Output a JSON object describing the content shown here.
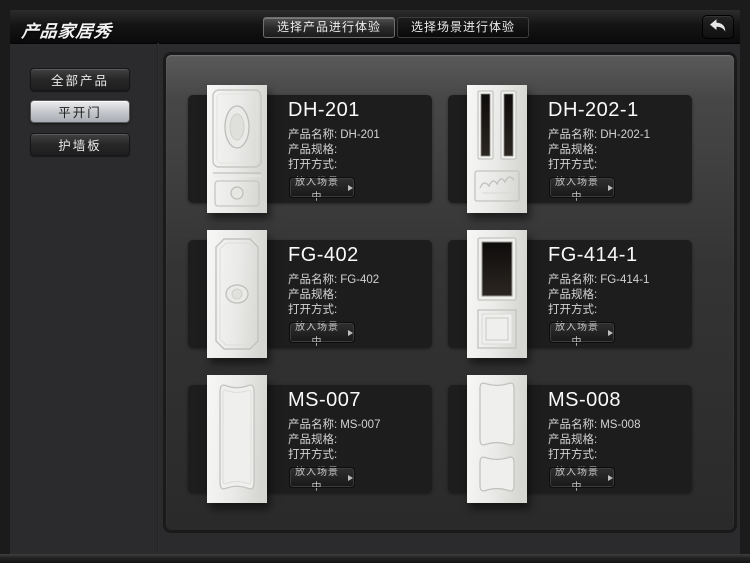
{
  "app": {
    "title": "产品家居秀"
  },
  "header": {
    "tabs": [
      {
        "label": "选择产品进行体验",
        "active": true
      },
      {
        "label": "选择场景进行体验",
        "active": false
      }
    ]
  },
  "sidebar": {
    "items": [
      {
        "label": "全部产品",
        "selected": false
      },
      {
        "label": "平开门",
        "selected": true
      },
      {
        "label": "护墙板",
        "selected": false
      }
    ]
  },
  "products": {
    "field_labels": {
      "name": "产品名称:",
      "spec": "产品规格:",
      "open": "打开方式:"
    },
    "action_label": "放入场景中",
    "cards": [
      {
        "title": "DH-201",
        "name": "DH-201",
        "spec": "",
        "open": ""
      },
      {
        "title": "DH-202-1",
        "name": "DH-202-1",
        "spec": "",
        "open": ""
      },
      {
        "title": "FG-402",
        "name": "FG-402",
        "spec": "",
        "open": ""
      },
      {
        "title": "FG-414-1",
        "name": "FG-414-1",
        "spec": "",
        "open": ""
      },
      {
        "title": "MS-007",
        "name": "MS-007",
        "spec": "",
        "open": ""
      },
      {
        "title": "MS-008",
        "name": "MS-008",
        "spec": "",
        "open": ""
      }
    ]
  },
  "colors": {
    "app_background": "#2b2b2d",
    "header_background": "#0d0d0d",
    "panel_top": "#5a5a5a",
    "panel_bottom": "#2a2a2a",
    "card_background": "#1d1d1d",
    "selected_sidebar_button": "#c3c6ca",
    "door_base": "#ececea",
    "glass_dark": "#151210"
  }
}
